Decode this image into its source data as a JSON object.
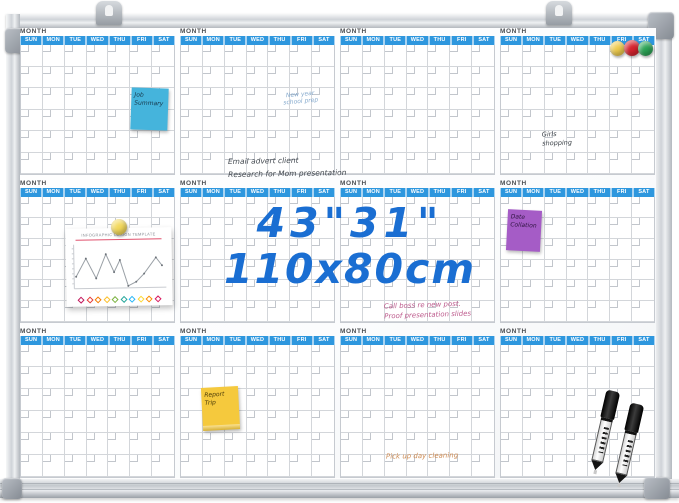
{
  "product": {
    "size_inches": "43\"31\"",
    "size_cm": "110x80cm",
    "accent_blue": "#1a6ed2"
  },
  "calendar": {
    "month_label": "MONTH",
    "day_labels": [
      "SUN",
      "MON",
      "TUE",
      "WED",
      "THU",
      "FRI",
      "SAT"
    ],
    "months_count": 12,
    "header_color": "#2e97de"
  },
  "sticky_notes": {
    "job_summary": {
      "text": "Job Summary",
      "color": "#45b4dc"
    },
    "date_collation": {
      "text": "Date Collation",
      "color": "#a55cc6"
    },
    "report_trip": {
      "text": "Report Trip",
      "color": "#f5c93d"
    }
  },
  "handwritten_notes": {
    "new_year": {
      "line1": "New year",
      "line2": "school prep",
      "color": "#84a9cd"
    },
    "email": {
      "line1": "Email advert client",
      "line2": "Research for Mom presentation",
      "color": "#42484f"
    },
    "girls": {
      "line1": "Girls",
      "line2": "shopping",
      "color": "#3c4248"
    },
    "call_boss": {
      "line1": "Call boss re new post.",
      "line2": "Proof presentation slides",
      "color": "#bd5a8c"
    },
    "pickup": {
      "text": "Pick up day cleaning",
      "color": "#cf8d55"
    }
  },
  "paper_chart": {
    "title": "INFOGRAPHIC DESIGN TEMPLATE",
    "line_points": [
      [
        6,
        34
      ],
      [
        16,
        16
      ],
      [
        26,
        36
      ],
      [
        36,
        12
      ],
      [
        44,
        30
      ],
      [
        50,
        18
      ],
      [
        58,
        44
      ],
      [
        66,
        40
      ],
      [
        74,
        32
      ],
      [
        86,
        16
      ],
      [
        92,
        24
      ]
    ],
    "diamond_colors": [
      "#c2185b",
      "#e53935",
      "#f57c00",
      "#fbc02d",
      "#7cb342",
      "#26a69a",
      "#29b6f6",
      "#fdd835",
      "#fb8c00",
      "#d81b60"
    ]
  },
  "magnets": {
    "colors": [
      "#eecb4e",
      "#d6232e",
      "#2ca456"
    ],
    "paper_pin_color": "#f3d95c"
  },
  "markers": {
    "count": 2,
    "color": "black"
  }
}
